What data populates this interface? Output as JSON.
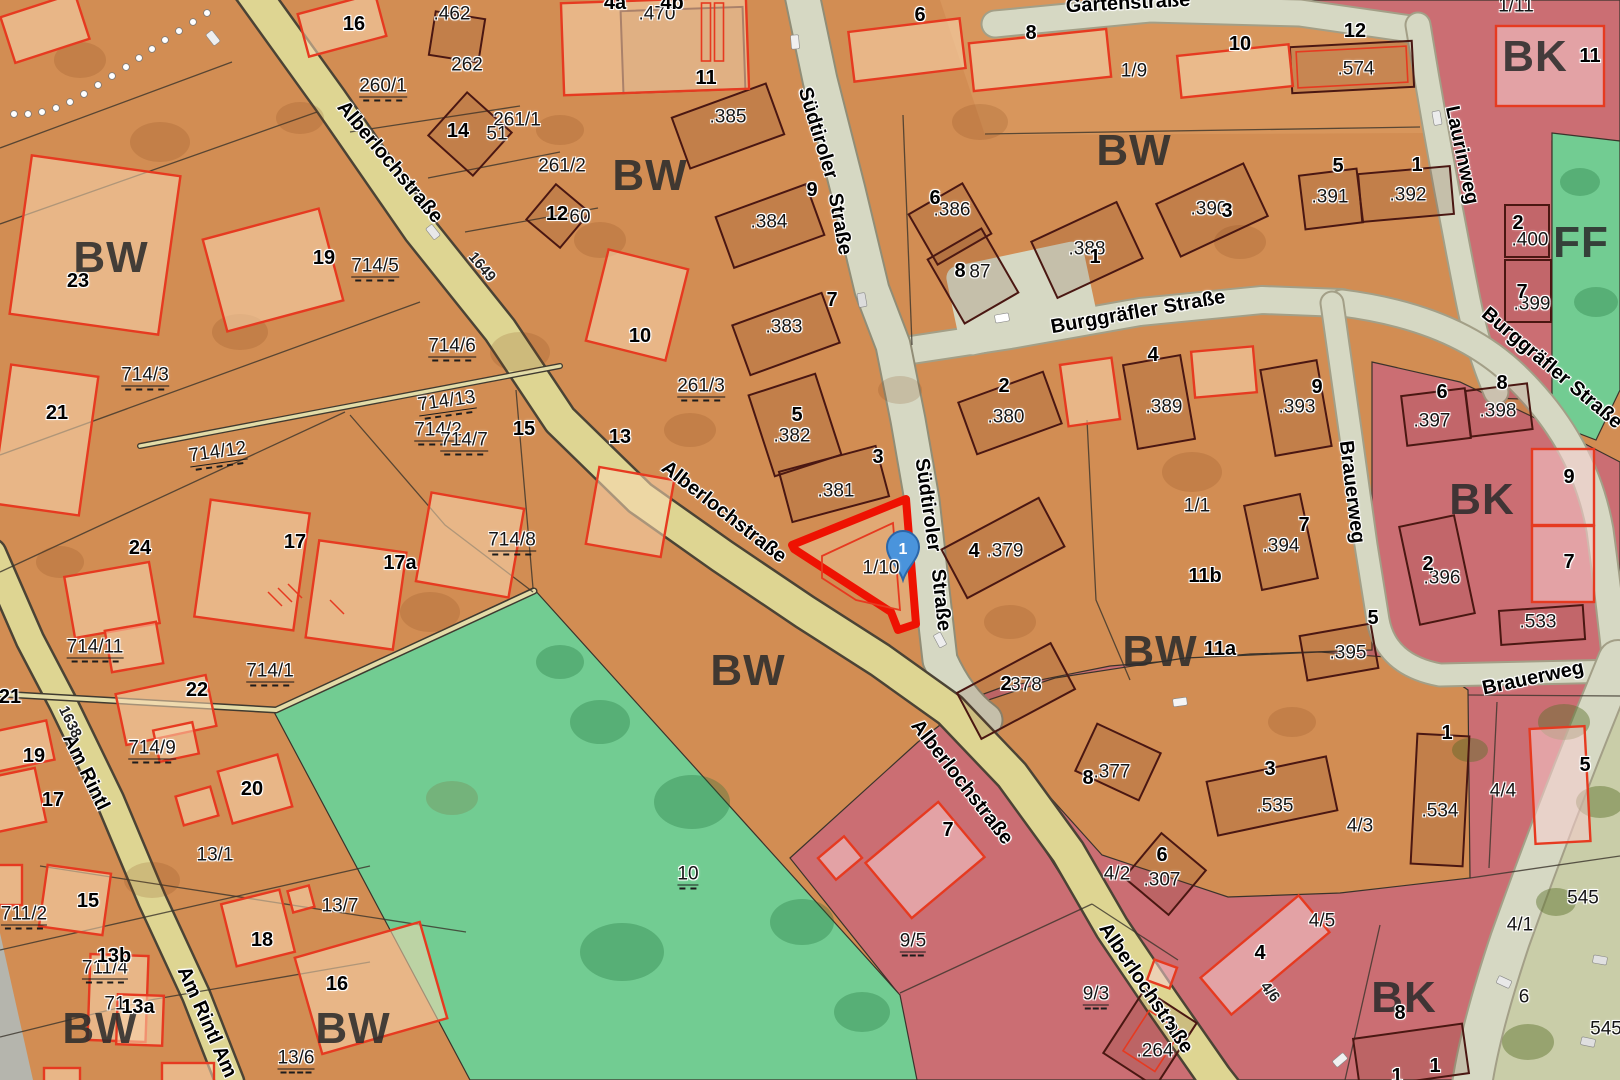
{
  "title": "Cadastral zoning map (Flurkarte)",
  "colors": {
    "orange_base": "#d28d53",
    "orange_light": "#dc9c63",
    "peach": "#edca9f",
    "green": "#72cc92",
    "pink": "#cb6e73",
    "pink_light": "#e2a3a5",
    "street_yellow": "#ded592",
    "street_pale": "#d6d8c3",
    "road_casing": "#4b4335",
    "bldg_dark": "#4a1712",
    "bldg_red": "#e63a20",
    "highlight_red": "#ee1202",
    "marker_blue": "#4a94dc",
    "marker_border": "#2b66a8"
  },
  "marker": {
    "label": "1",
    "x": 903,
    "y": 552
  },
  "highlight": {
    "parcel": "1/10"
  },
  "labels": {
    "zones": [
      {
        "text": "BW",
        "x": 111,
        "y": 258
      },
      {
        "text": "BW",
        "x": 650,
        "y": 176
      },
      {
        "text": "BW",
        "x": 1134,
        "y": 151
      },
      {
        "text": "BW",
        "x": 748,
        "y": 671
      },
      {
        "text": "BW",
        "x": 1160,
        "y": 652
      },
      {
        "text": "BW",
        "x": 100,
        "y": 1029
      },
      {
        "text": "BW",
        "x": 353,
        "y": 1029
      },
      {
        "text": "BK",
        "x": 1535,
        "y": 57
      },
      {
        "text": "BK",
        "x": 1482,
        "y": 500
      },
      {
        "text": "BK",
        "x": 1404,
        "y": 998
      },
      {
        "text": "FF",
        "x": 1581,
        "y": 243
      }
    ],
    "streets": [
      {
        "text": "Alberlochstraße",
        "x": 390,
        "y": 162,
        "rot": 50
      },
      {
        "text": "Alberlochstraße",
        "x": 724,
        "y": 512,
        "rot": 38
      },
      {
        "text": "Alberlochstraße",
        "x": 962,
        "y": 782,
        "rot": 52
      },
      {
        "text": "Alberlochstraße",
        "x": 1146,
        "y": 988,
        "rot": 56
      },
      {
        "text": "Südtiroler",
        "x": 818,
        "y": 133,
        "rot": 73
      },
      {
        "text": "Straße",
        "x": 840,
        "y": 224,
        "rot": 80
      },
      {
        "text": "Südtiroler",
        "x": 928,
        "y": 505,
        "rot": 82
      },
      {
        "text": "Straße",
        "x": 941,
        "y": 600,
        "rot": 84
      },
      {
        "text": "Burggräfler Straße",
        "x": 1138,
        "y": 312,
        "rot": -10
      },
      {
        "text": "Burggräfler Straße",
        "x": 1552,
        "y": 368,
        "rot": 40
      },
      {
        "text": "Laurinweg",
        "x": 1462,
        "y": 155,
        "rot": 78
      },
      {
        "text": "Brauerweg",
        "x": 1352,
        "y": 492,
        "rot": 83
      },
      {
        "text": "Brauerweg",
        "x": 1533,
        "y": 678,
        "rot": -12
      },
      {
        "text": "Gartenstraße",
        "x": 1128,
        "y": 3,
        "rot": -3
      },
      {
        "text": "Am Rintl",
        "x": 86,
        "y": 772,
        "rot": 64
      },
      {
        "text": "Am Rintl Am",
        "x": 207,
        "y": 1022,
        "rot": 66
      }
    ],
    "street_nums": [
      {
        "text": "1638",
        "x": 70,
        "y": 722,
        "rot": 64
      },
      {
        "text": "1649",
        "x": 482,
        "y": 267,
        "rot": 50
      },
      {
        "text": "4/6",
        "x": 1270,
        "y": 992,
        "rot": 52
      }
    ],
    "parcels_dashed": [
      {
        "text": "714/2",
        "x": 438,
        "y": 433
      },
      {
        "text": "714/3",
        "x": 145,
        "y": 378
      },
      {
        "text": "714/5",
        "x": 375,
        "y": 269
      },
      {
        "text": "714/6",
        "x": 452,
        "y": 349
      },
      {
        "text": "714/12",
        "x": 218,
        "y": 455,
        "rot": -8
      },
      {
        "text": "714/13",
        "x": 447,
        "y": 404,
        "rot": -8
      },
      {
        "text": "714/7",
        "x": 464,
        "y": 443
      },
      {
        "text": "714/8",
        "x": 512,
        "y": 543
      },
      {
        "text": "714/11",
        "x": 95,
        "y": 650
      },
      {
        "text": "714/1",
        "x": 270,
        "y": 674
      },
      {
        "text": "714/9",
        "x": 152,
        "y": 751
      },
      {
        "text": "711/2",
        "x": 24,
        "y": 917
      },
      {
        "text": "711/4",
        "x": 105,
        "y": 971
      },
      {
        "text": "260/1",
        "x": 383,
        "y": 89
      },
      {
        "text": "261/3",
        "x": 701,
        "y": 389
      },
      {
        "text": "9/5",
        "x": 913,
        "y": 944
      },
      {
        "text": "9/3",
        "x": 1096,
        "y": 997
      },
      {
        "text": "13/6",
        "x": 296,
        "y": 1061
      },
      {
        "text": "10",
        "x": 688,
        "y": 877
      }
    ],
    "parcels": [
      {
        "text": "262",
        "x": 467,
        "y": 65
      },
      {
        "text": "261/1",
        "x": 517,
        "y": 120
      },
      {
        "text": "261/2",
        "x": 562,
        "y": 166
      },
      {
        "text": "1/9",
        "x": 1134,
        "y": 71
      },
      {
        "text": "1/11",
        "x": 1516,
        "y": 6
      },
      {
        "text": "1/1",
        "x": 1197,
        "y": 506
      },
      {
        "text": "1/10",
        "x": 881,
        "y": 568
      },
      {
        "text": "13/1",
        "x": 215,
        "y": 855
      },
      {
        "text": "13/7",
        "x": 340,
        "y": 906
      },
      {
        "text": "4/3",
        "x": 1360,
        "y": 826
      },
      {
        "text": "4/2",
        "x": 1117,
        "y": 874
      },
      {
        "text": "4/5",
        "x": 1322,
        "y": 921
      },
      {
        "text": "4/4",
        "x": 1503,
        "y": 791
      },
      {
        "text": "4/1",
        "x": 1520,
        "y": 925
      },
      {
        "text": "6",
        "x": 1524,
        "y": 997
      },
      {
        "text": "545",
        "x": 1583,
        "y": 898
      },
      {
        "text": "545",
        "x": 1606,
        "y": 1029
      },
      {
        "text": ".385",
        "x": 728,
        "y": 117
      },
      {
        "text": ".384",
        "x": 769,
        "y": 222
      },
      {
        "text": ".383",
        "x": 784,
        "y": 327
      },
      {
        "text": ".382",
        "x": 792,
        "y": 436
      },
      {
        "text": ".381",
        "x": 836,
        "y": 491
      },
      {
        "text": ".380",
        "x": 1006,
        "y": 417
      },
      {
        "text": ".379",
        "x": 1005,
        "y": 551
      },
      {
        "text": "378",
        "x": 1026,
        "y": 685
      },
      {
        "text": ".386",
        "x": 952,
        "y": 210
      },
      {
        "text": "87",
        "x": 980,
        "y": 272
      },
      {
        "text": ".388",
        "x": 1087,
        "y": 249
      },
      {
        "text": ".390",
        "x": 1209,
        "y": 209
      },
      {
        "text": ".391",
        "x": 1330,
        "y": 197
      },
      {
        "text": ".392",
        "x": 1408,
        "y": 195
      },
      {
        "text": ".574",
        "x": 1356,
        "y": 69
      },
      {
        "text": ".389",
        "x": 1164,
        "y": 407
      },
      {
        "text": ".393",
        "x": 1297,
        "y": 407
      },
      {
        "text": ".394",
        "x": 1281,
        "y": 546
      },
      {
        "text": ".395",
        "x": 1348,
        "y": 653
      },
      {
        "text": ".396",
        "x": 1442,
        "y": 578
      },
      {
        "text": ".397",
        "x": 1432,
        "y": 421
      },
      {
        "text": ".398",
        "x": 1498,
        "y": 411
      },
      {
        "text": ".533",
        "x": 1538,
        "y": 622
      },
      {
        "text": ".400",
        "x": 1530,
        "y": 240
      },
      {
        "text": ".399",
        "x": 1532,
        "y": 304
      },
      {
        "text": ".535",
        "x": 1275,
        "y": 806
      },
      {
        "text": ".534",
        "x": 1440,
        "y": 811
      },
      {
        "text": ".377",
        "x": 1112,
        "y": 772
      },
      {
        "text": ".307",
        "x": 1162,
        "y": 880
      },
      {
        "text": ".264",
        "x": 1155,
        "y": 1051
      },
      {
        "text": ".462",
        "x": 452,
        "y": 14
      },
      {
        "text": ".470",
        "x": 657,
        "y": 14
      },
      {
        "text": "51",
        "x": 497,
        "y": 134
      },
      {
        "text": "60",
        "x": 580,
        "y": 217
      },
      {
        "text": "71",
        "x": 115,
        "y": 1004
      }
    ],
    "houses": [
      {
        "text": "16",
        "x": 354,
        "y": 24
      },
      {
        "text": "4b",
        "x": 672,
        "y": 3
      },
      {
        "text": "4a",
        "x": 615,
        "y": 3
      },
      {
        "text": "14",
        "x": 458,
        "y": 131
      },
      {
        "text": "12",
        "x": 557,
        "y": 214
      },
      {
        "text": "11",
        "x": 706,
        "y": 78
      },
      {
        "text": "9",
        "x": 812,
        "y": 190
      },
      {
        "text": "7",
        "x": 832,
        "y": 300
      },
      {
        "text": "5",
        "x": 797,
        "y": 415
      },
      {
        "text": "3",
        "x": 878,
        "y": 457
      },
      {
        "text": "10",
        "x": 640,
        "y": 336
      },
      {
        "text": "23",
        "x": 78,
        "y": 281
      },
      {
        "text": "19",
        "x": 324,
        "y": 258
      },
      {
        "text": "21",
        "x": 57,
        "y": 413
      },
      {
        "text": "24",
        "x": 140,
        "y": 548
      },
      {
        "text": "22",
        "x": 197,
        "y": 690
      },
      {
        "text": "17",
        "x": 295,
        "y": 542
      },
      {
        "text": "17a",
        "x": 400,
        "y": 563
      },
      {
        "text": "15",
        "x": 524,
        "y": 429
      },
      {
        "text": "13",
        "x": 620,
        "y": 437
      },
      {
        "text": "20",
        "x": 252,
        "y": 789
      },
      {
        "text": "18",
        "x": 262,
        "y": 940
      },
      {
        "text": "16",
        "x": 337,
        "y": 984
      },
      {
        "text": "19",
        "x": 34,
        "y": 756
      },
      {
        "text": "17",
        "x": 53,
        "y": 800
      },
      {
        "text": "15",
        "x": 88,
        "y": 901
      },
      {
        "text": "13b",
        "x": 114,
        "y": 956
      },
      {
        "text": "13a",
        "x": 138,
        "y": 1007
      },
      {
        "text": "21",
        "x": 10,
        "y": 697
      },
      {
        "text": "6",
        "x": 935,
        "y": 198
      },
      {
        "text": "8",
        "x": 960,
        "y": 271
      },
      {
        "text": "1",
        "x": 1095,
        "y": 257
      },
      {
        "text": "3",
        "x": 1227,
        "y": 211
      },
      {
        "text": "5",
        "x": 1338,
        "y": 166
      },
      {
        "text": "1",
        "x": 1417,
        "y": 165
      },
      {
        "text": "12",
        "x": 1355,
        "y": 31
      },
      {
        "text": "10",
        "x": 1240,
        "y": 44
      },
      {
        "text": "8",
        "x": 1031,
        "y": 33
      },
      {
        "text": "6",
        "x": 920,
        "y": 15
      },
      {
        "text": "2",
        "x": 1004,
        "y": 386
      },
      {
        "text": "4",
        "x": 974,
        "y": 551
      },
      {
        "text": "2",
        "x": 1006,
        "y": 684
      },
      {
        "text": "4",
        "x": 1153,
        "y": 355
      },
      {
        "text": "9",
        "x": 1317,
        "y": 387
      },
      {
        "text": "7",
        "x": 1304,
        "y": 525
      },
      {
        "text": "5",
        "x": 1373,
        "y": 618
      },
      {
        "text": "11b",
        "x": 1205,
        "y": 576
      },
      {
        "text": "11a",
        "x": 1220,
        "y": 649
      },
      {
        "text": "11",
        "x": 1590,
        "y": 56
      },
      {
        "text": "2",
        "x": 1518,
        "y": 223
      },
      {
        "text": "7",
        "x": 1522,
        "y": 292
      },
      {
        "text": "6",
        "x": 1442,
        "y": 392
      },
      {
        "text": "8",
        "x": 1502,
        "y": 383
      },
      {
        "text": "9",
        "x": 1569,
        "y": 477
      },
      {
        "text": "7",
        "x": 1569,
        "y": 562
      },
      {
        "text": "2",
        "x": 1428,
        "y": 564
      },
      {
        "text": "3",
        "x": 1270,
        "y": 769
      },
      {
        "text": "1",
        "x": 1447,
        "y": 733
      },
      {
        "text": "8",
        "x": 1088,
        "y": 778
      },
      {
        "text": "6",
        "x": 1162,
        "y": 855
      },
      {
        "text": "3",
        "x": 1170,
        "y": 1024
      },
      {
        "text": "5",
        "x": 1585,
        "y": 765
      },
      {
        "text": "4",
        "x": 1260,
        "y": 953
      },
      {
        "text": "7",
        "x": 948,
        "y": 830
      },
      {
        "text": "1",
        "x": 1435,
        "y": 1066
      },
      {
        "text": "1",
        "x": 1397,
        "y": 1076
      },
      {
        "text": "8",
        "x": 1400,
        "y": 1013
      }
    ]
  }
}
